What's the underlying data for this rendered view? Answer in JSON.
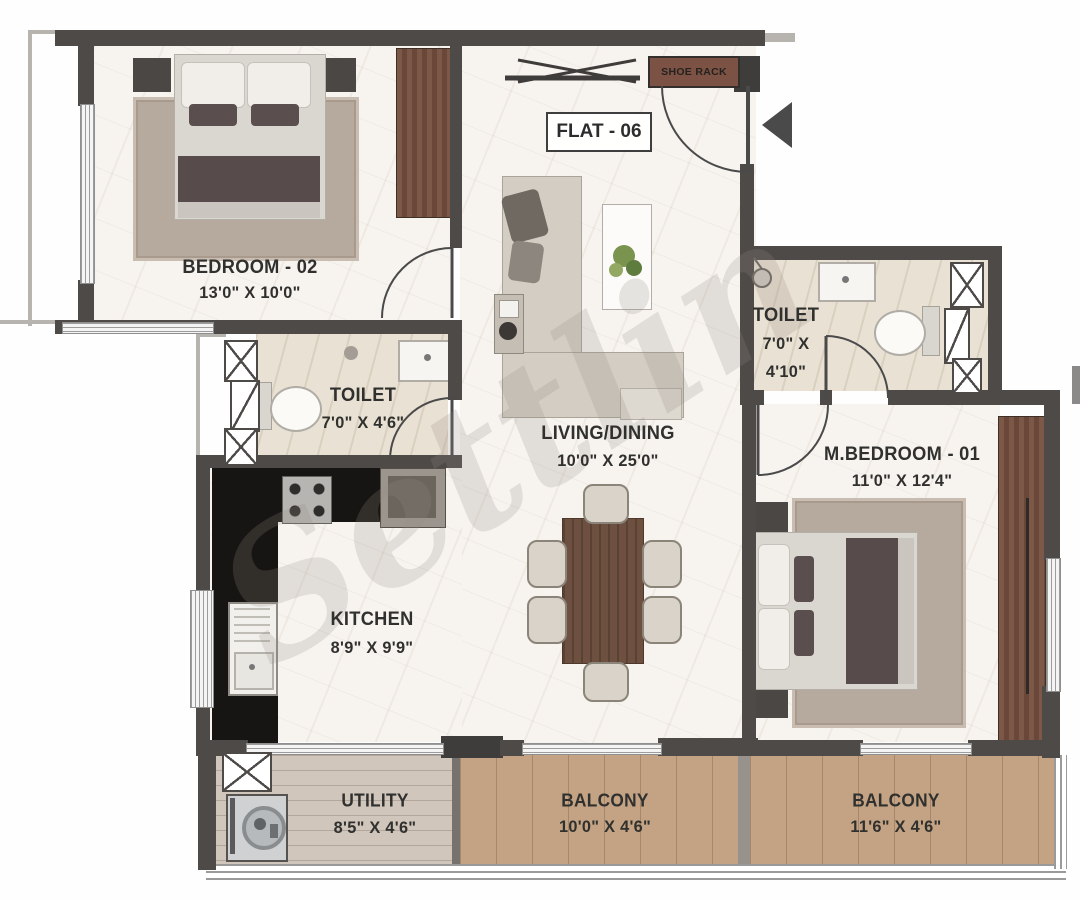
{
  "watermark": "Settlin",
  "entrance": {
    "flat_label": "FLAT - 06",
    "shoe_rack": "SHOE RACK"
  },
  "rooms": {
    "bedroom2": {
      "name": "BEDROOM - 02",
      "dims": "13'0\" X 10'0\""
    },
    "toilet1": {
      "name": "TOILET",
      "dims": "7'0\" X 4'6\""
    },
    "toilet2": {
      "name": "TOILET",
      "dims_l1": "7'0\" X",
      "dims_l2": "4'10\""
    },
    "living": {
      "name": "LIVING/DINING",
      "dims": "10'0\" X 25'0\""
    },
    "kitchen": {
      "name": "KITCHEN",
      "dims": "8'9\" X 9'9\""
    },
    "mbedroom": {
      "name": "M.BEDROOM - 01",
      "dims": "11'0\" X 12'4\""
    },
    "utility": {
      "name": "UTILITY",
      "dims": "8'5\" X 4'6\""
    },
    "balcony1": {
      "name": "BALCONY",
      "dims": "10'0\" X 4'6\""
    },
    "balcony2": {
      "name": "BALCONY",
      "dims": "11'6\" X 4'6\""
    }
  },
  "icons": {
    "entrance_marker": "arrow-left",
    "shafts": "x-cross-duct"
  },
  "colors": {
    "wall": "#4d4a48",
    "marble_floor": "#f7f4f0",
    "toilet_floor": "#e9e1d3",
    "wardrobe_wood": "#7c5848",
    "balcony_wood": "#c3a383",
    "utility_wood": "#d0c6bc",
    "kitchen_counter": "#171513",
    "rug": "#b6a99d",
    "shoe_rack": "#7b5244",
    "label_text": "#30302e",
    "watermark": "rgba(150,140,132,0.22)"
  }
}
